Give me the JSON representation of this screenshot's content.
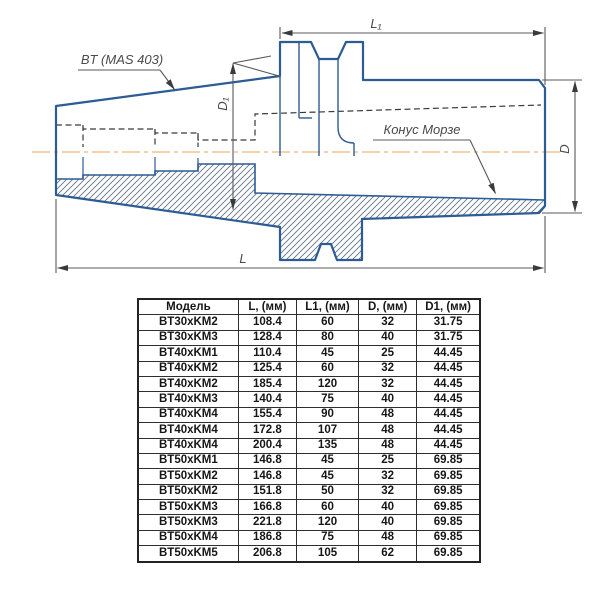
{
  "drawing": {
    "labels": {
      "shank_standard": "BT (MAS 403)",
      "morse_taper": "Конус Морзе",
      "dim_l1": "L₁",
      "dim_l": "L",
      "dim_d": "D",
      "dim_d1": "D₁"
    },
    "colors": {
      "outline_blue": "#2d5b94",
      "centerline_orange": "#efc391",
      "dimension_gray": "#58595b",
      "hidden_line": "#3a3a3a",
      "hatch": "#64758a"
    }
  },
  "table": {
    "headers": [
      "Модель",
      "L, (мм)",
      "L1, (мм)",
      "D, (мм)",
      "D1, (мм)"
    ],
    "col_widths": [
      100,
      58,
      62,
      58,
      63
    ],
    "rows": [
      [
        "BT30xKM2",
        "108.4",
        "60",
        "32",
        "31.75"
      ],
      [
        "BT30xKM3",
        "128.4",
        "80",
        "40",
        "31.75"
      ],
      [
        "BT40xKM1",
        "110.4",
        "45",
        "25",
        "44.45"
      ],
      [
        "BT40xKM2",
        "125.4",
        "60",
        "32",
        "44.45"
      ],
      [
        "BT40xKM2",
        "185.4",
        "120",
        "32",
        "44.45"
      ],
      [
        "BT40xKM3",
        "140.4",
        "75",
        "40",
        "44.45"
      ],
      [
        "BT40xKM4",
        "155.4",
        "90",
        "48",
        "44.45"
      ],
      [
        "BT40xKM4",
        "172.8",
        "107",
        "48",
        "44.45"
      ],
      [
        "BT40xKM4",
        "200.4",
        "135",
        "48",
        "44.45"
      ],
      [
        "BT50xKM1",
        "146.8",
        "45",
        "25",
        "69.85"
      ],
      [
        "BT50xKM2",
        "146.8",
        "45",
        "32",
        "69.85"
      ],
      [
        "BT50xKM2",
        "151.8",
        "50",
        "32",
        "69.85"
      ],
      [
        "BT50xKM3",
        "166.8",
        "60",
        "40",
        "69.85"
      ],
      [
        "BT50xKM3",
        "221.8",
        "120",
        "40",
        "69.85"
      ],
      [
        "BT50xKM4",
        "186.8",
        "75",
        "48",
        "69.85"
      ],
      [
        "BT50xKM5",
        "206.8",
        "105",
        "62",
        "69.85"
      ]
    ]
  }
}
